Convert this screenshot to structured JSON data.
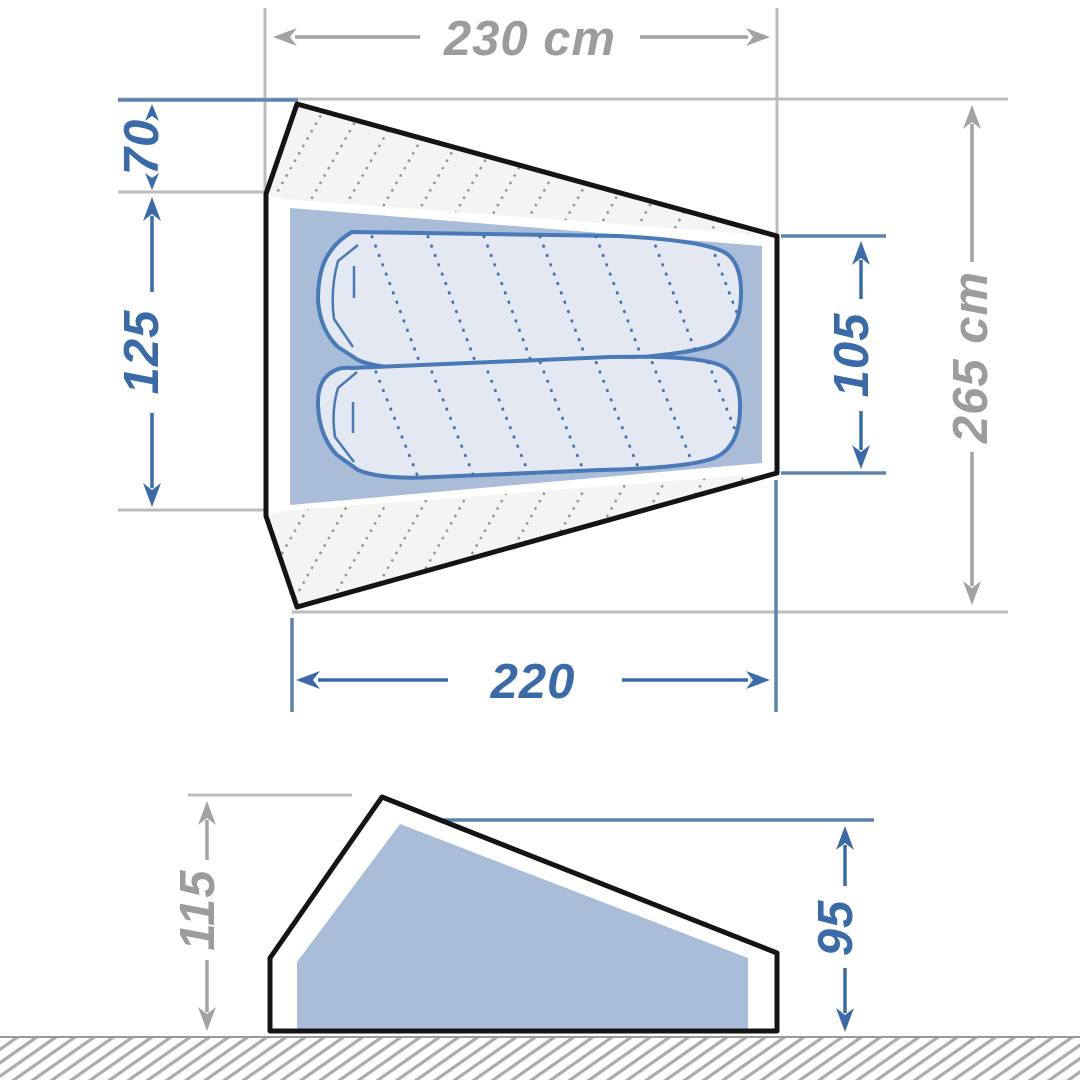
{
  "diagram": {
    "type": "tent-dimension-drawing",
    "views": {
      "top": {
        "name": "top view floor plan",
        "dimensions": {
          "outer_width": {
            "label": "230 cm"
          },
          "vestibule_depth": {
            "label": "70"
          },
          "bedroom_width_left": {
            "label": "125"
          },
          "bedroom_width_right": {
            "label": "105"
          },
          "outer_length": {
            "label": "265 cm"
          },
          "bedroom_length": {
            "label": "220"
          }
        },
        "sleeping_pads_count": 2
      },
      "side": {
        "name": "side elevation",
        "dimensions": {
          "outer_height": {
            "label": "115"
          },
          "inner_height": {
            "label": "95"
          }
        }
      }
    },
    "colors": {
      "dimension_blue": "#3a6aa8",
      "dimension_gray": "#a2a2a2",
      "extension_blue": "#5b83ad",
      "extension_gray": "#bcbcbc",
      "outline_black": "#141414",
      "inner_floor_blue": "#a9bcd8",
      "pad_fill": "#e4e8f2",
      "pad_outline": "#4a79b8",
      "hatch_gray": "#8d949c",
      "ground_stripe_gray": "#ababab",
      "background": "#ffffff"
    }
  }
}
